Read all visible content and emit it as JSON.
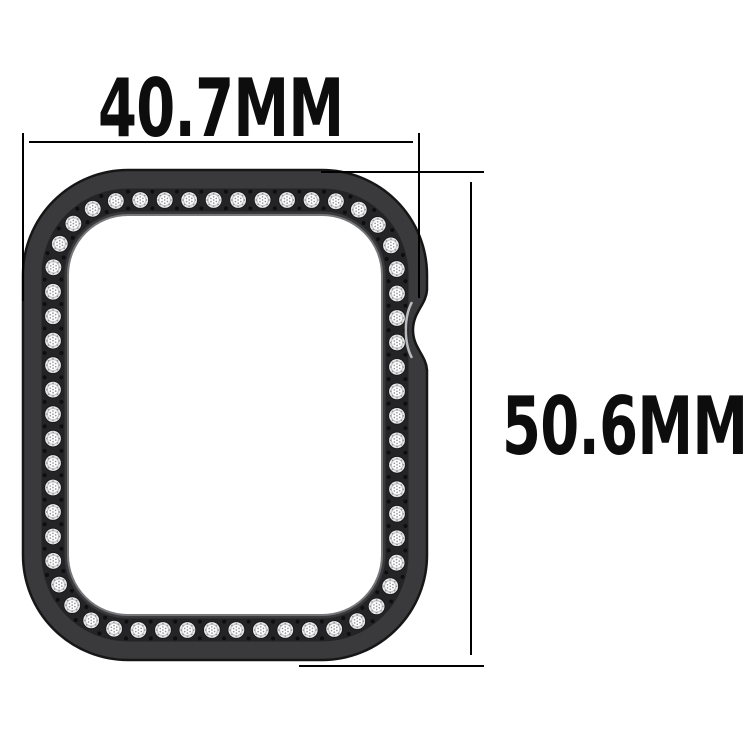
{
  "measurements": {
    "width": "40.7MM",
    "height": "50.6MM"
  },
  "colors": {
    "bg": "#ffffff",
    "text": "#0d0d0d",
    "line": "#000000",
    "case-body": "#3a3a3c",
    "case-outline": "#161616",
    "channel": "#242427",
    "opening-rim": "#77787a",
    "notch-highlight": "#b9bcbe"
  },
  "illustration": {
    "stone_spacing": 24.4,
    "stone_radius": 7.9,
    "stone_hole_radius": 8.8,
    "stone_face_ratio": 0.72,
    "facet_outer_radius": 6.3,
    "facet_inner_radius": 3.1,
    "facet_dot_radius": 0.85,
    "gap_dot_radius": 2,
    "gap_dot_offset": 8.4,
    "colors": {
      "hole": "#18181a",
      "base": "#e9e9ea",
      "face": "#ffffff",
      "ring": "#c6c6c8",
      "facet_dot": "#97979a",
      "gap_dot": "#0e0e0e"
    }
  }
}
